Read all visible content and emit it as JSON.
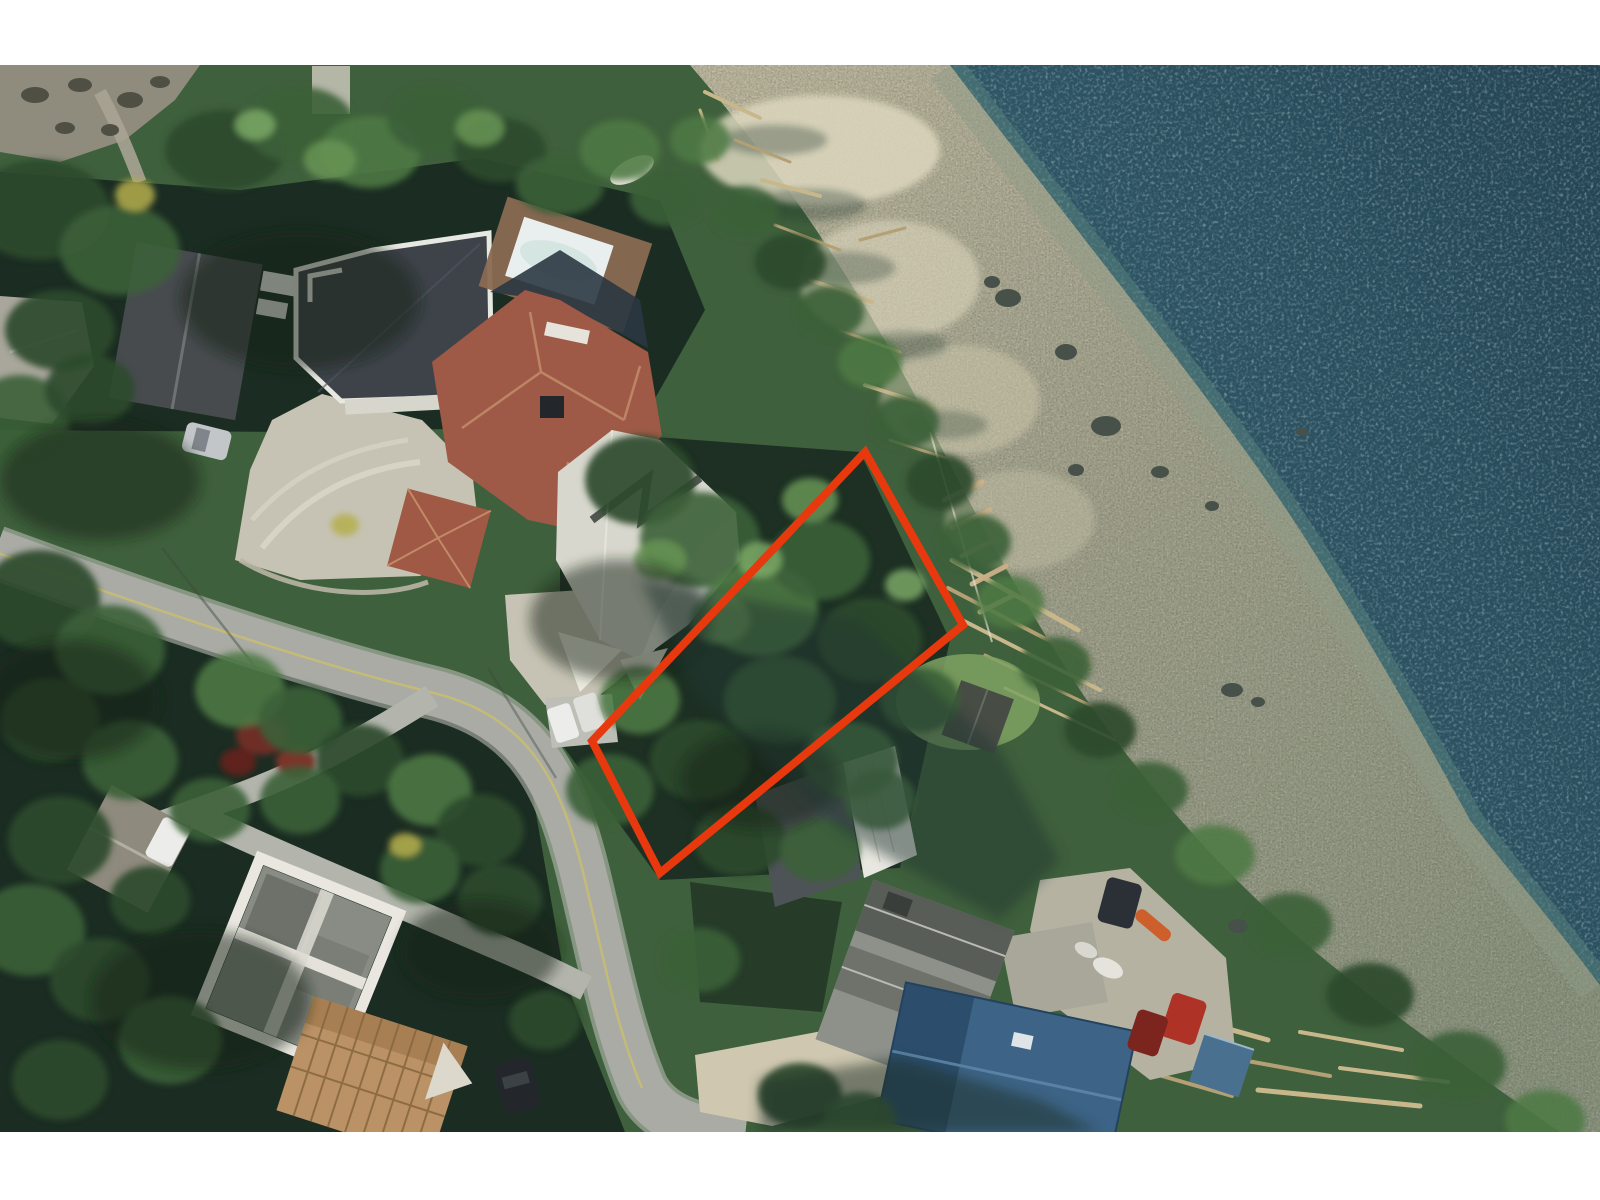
{
  "page": {
    "background_color": "#ffffff",
    "description": "Aerial photograph of a waterfront residential neighbourhood with one lot outlined in red"
  },
  "photo": {
    "x": 0,
    "y": 65,
    "width": 1600,
    "height": 1067,
    "kind": "orthophoto",
    "features": [
      "deep teal ocean water",
      "gravel beach with driftwood logs",
      "shoreline conifers",
      "residential houses",
      "curving road",
      "concrete driveways",
      "red lot outline"
    ]
  },
  "annotation": {
    "name": "property-boundary",
    "shape": "quadrilateral",
    "points": "865,452 963,625 660,873 592,741",
    "stroke_color": "#e8380d",
    "stroke_width": 8
  },
  "scene": {
    "colors": {
      "water_deep": "#234453",
      "water_mid": "#2e5665",
      "water_shallow": "#47706e",
      "beach_light": "#cfc9ad",
      "beach_mid": "#b2b29a",
      "beach_low": "#98a28a",
      "sand_bright": "#dcd6bd",
      "bluff_rock": "#8f8c7d",
      "road": "#a9aba4",
      "road_branch": "#b3b5ac",
      "centerline": "#cfc069",
      "concrete": "#c6c3b4",
      "patio": "#b5b2a2",
      "land_base": "#3f603c",
      "shadow": "#15241d",
      "roof_far_left": "#a9a79b",
      "roof_dark_gable": "#474b4e",
      "roof_charcoal": "#3e434a",
      "roof_trim_white": "#e8e8e2",
      "roof_red": "#9e5a46",
      "roof_red_small": "#a05944",
      "roof_light_house": "#d8d7cd",
      "roof_metal_white": "#e8e7e0",
      "roof_gray_house": "#8e918a",
      "roof_blue": "#3d6486",
      "roof_blue_dark": "#2c4e6c",
      "roof_blue_shed": "#49708f",
      "roof_white_modern": "#e9e7df",
      "construction_wood": "#bb9266",
      "pool_water": "#e9efee",
      "pool_deck": "#8a6a52",
      "shed_dark": "#474c45",
      "lawn": "#7fa263",
      "driftwood": "#c9b78c",
      "car_silver": "#c2c6c9",
      "car_white": "#ecedea",
      "car_dark": "#23272b",
      "car_red": "#ae3326",
      "car_maroon": "#7c241e",
      "kayak_orange": "#cd5f2d",
      "maple_maroon": "#6e2d26"
    }
  }
}
